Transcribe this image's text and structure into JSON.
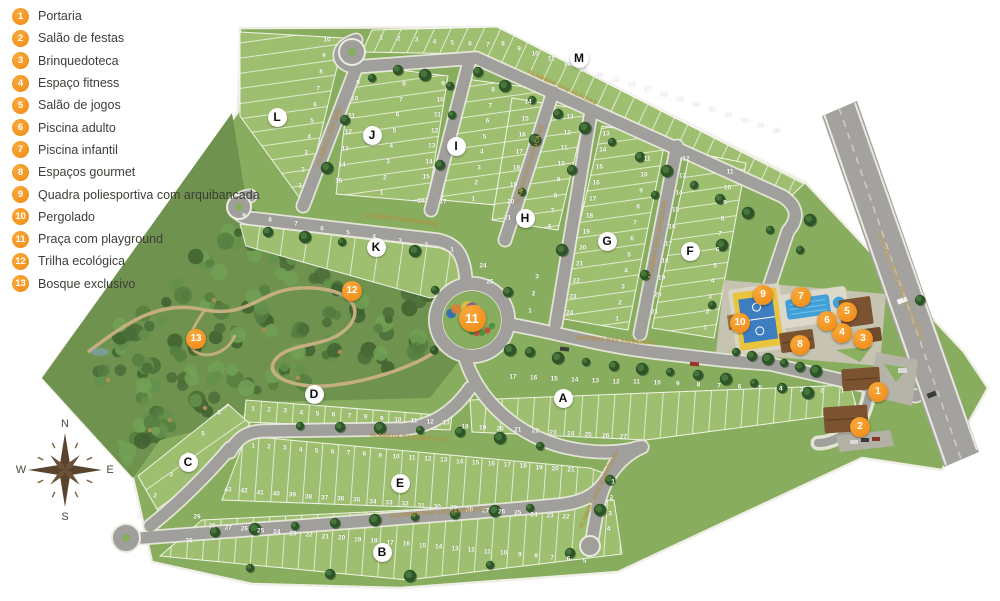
{
  "colors": {
    "accent_orange": "#F28A12",
    "lawn": "#89ad5e",
    "block_green": "#9fbf70",
    "forest": "#6f924e",
    "road": "#a09f9b",
    "curb": "#ecebe3",
    "street_label": "#c09a4e",
    "pool_blue": "#41a0d8",
    "court_blue": "#3e7dbf",
    "court_yellow": "#e9c43d",
    "roof_brown": "#7b5330",
    "compass_brown": "#5a432d"
  },
  "legend": {
    "items": [
      {
        "num": "1",
        "label": "Portaria"
      },
      {
        "num": "2",
        "label": "Salão de festas"
      },
      {
        "num": "3",
        "label": "Brinquedoteca"
      },
      {
        "num": "4",
        "label": "Espaço fitness"
      },
      {
        "num": "5",
        "label": "Salão de jogos"
      },
      {
        "num": "6",
        "label": "Piscina adulto"
      },
      {
        "num": "7",
        "label": "Piscina infantil"
      },
      {
        "num": "8",
        "label": "Espaços gourmet"
      },
      {
        "num": "9",
        "label": "Quadra poliesportiva com arquibancada"
      },
      {
        "num": "10",
        "label": "Pergolado"
      },
      {
        "num": "11",
        "label": "Praça com playground"
      },
      {
        "num": "12",
        "label": "Trilha ecológica"
      },
      {
        "num": "13",
        "label": "Bosque exclusivo"
      }
    ]
  },
  "compass": {
    "n": "N",
    "e": "E",
    "s": "S",
    "w": "W"
  },
  "map": {
    "block_labels": [
      {
        "letter": "A",
        "x": 563,
        "y": 398
      },
      {
        "letter": "B",
        "x": 382,
        "y": 552
      },
      {
        "letter": "C",
        "x": 188,
        "y": 462
      },
      {
        "letter": "D",
        "x": 314,
        "y": 394
      },
      {
        "letter": "E",
        "x": 400,
        "y": 483
      },
      {
        "letter": "F",
        "x": 690,
        "y": 251
      },
      {
        "letter": "G",
        "x": 607,
        "y": 241
      },
      {
        "letter": "H",
        "x": 525,
        "y": 218
      },
      {
        "letter": "I",
        "x": 456,
        "y": 146
      },
      {
        "letter": "J",
        "x": 372,
        "y": 135
      },
      {
        "letter": "K",
        "x": 376,
        "y": 247
      },
      {
        "letter": "L",
        "x": 277,
        "y": 117
      },
      {
        "letter": "M",
        "x": 579,
        "y": 58
      }
    ],
    "markers": [
      {
        "num": "1",
        "x": 878,
        "y": 392
      },
      {
        "num": "2",
        "x": 860,
        "y": 427
      },
      {
        "num": "3",
        "x": 863,
        "y": 339
      },
      {
        "num": "4",
        "x": 842,
        "y": 333
      },
      {
        "num": "5",
        "x": 847,
        "y": 312
      },
      {
        "num": "6",
        "x": 827,
        "y": 321
      },
      {
        "num": "7",
        "x": 801,
        "y": 297
      },
      {
        "num": "8",
        "x": 800,
        "y": 345
      },
      {
        "num": "9",
        "x": 763,
        "y": 295
      },
      {
        "num": "10",
        "x": 740,
        "y": 323
      },
      {
        "num": "11",
        "x": 472,
        "y": 318
      },
      {
        "num": "12",
        "x": 352,
        "y": 291
      },
      {
        "num": "13",
        "x": 196,
        "y": 339
      }
    ],
    "street_labels": [
      {
        "text": "ALAMEDA DAS ACÁCIAS",
        "x": 562,
        "y": 88,
        "rot": 25,
        "cls": ""
      },
      {
        "text": "ALAMEDA DOS PINHAIS",
        "x": 402,
        "y": 220,
        "rot": 7,
        "cls": ""
      },
      {
        "text": "ALAMEDA DOS ANGICOS",
        "x": 408,
        "y": 438,
        "rot": 4,
        "cls": ""
      },
      {
        "text": "ALAMEDA DAS CASTANHEIRAS",
        "x": 438,
        "y": 513,
        "rot": -4,
        "cls": ""
      },
      {
        "text": "AVENIDA DAS FIGUEIRAS",
        "x": 616,
        "y": 341,
        "rot": 4,
        "cls": ""
      },
      {
        "text": "ALAMEDA DAS MAGNÓLIAS",
        "x": 599,
        "y": 490,
        "rot": -65,
        "cls": ""
      },
      {
        "text": "ALAMEDA DOS IPÊS",
        "x": 330,
        "y": 136,
        "rot": -69,
        "cls": ""
      },
      {
        "text": "ALAMEDA DAS SAPUCAIAS",
        "x": 530,
        "y": 165,
        "rot": -72,
        "cls": ""
      },
      {
        "text": "ALAMEDA DAS AROEIRAS",
        "x": 658,
        "y": 240,
        "rot": -79,
        "cls": ""
      },
      {
        "text": "ESTRADA MUNICIPAL DO ROSÁRIO",
        "x": 900,
        "y": 288,
        "rot": 68,
        "cls": "hwy"
      }
    ],
    "lot_strips": [
      {
        "block": "L",
        "x": 327,
        "y": 40,
        "dx": -3,
        "dy": 16.2,
        "values": [
          "10",
          "9",
          "8",
          "7",
          "6",
          "5",
          "4",
          "3",
          "2",
          "1"
        ]
      },
      {
        "block": "M",
        "x": 381,
        "y": 38,
        "dx": 17.8,
        "dy": 1.2,
        "values": [
          "1",
          "2",
          "3",
          "4",
          "5",
          "6",
          "7"
        ]
      },
      {
        "block": "M",
        "x": 503,
        "y": 44,
        "dx": 16.1,
        "dy": 5.1,
        "values": [
          "8",
          "9",
          "10",
          "11",
          "12",
          "13",
          "14",
          "15",
          "16",
          "17",
          "18",
          "19",
          "20",
          "21",
          "22",
          "23",
          "24",
          "25"
        ]
      },
      {
        "block": "J",
        "x": 358,
        "y": 83,
        "dx": -3.2,
        "dy": 16.4,
        "values": [
          "9",
          "10",
          "11",
          "12",
          "13",
          "14",
          "15"
        ]
      },
      {
        "block": "J",
        "x": 404,
        "y": 84,
        "dx": -3.2,
        "dy": 15.6,
        "values": [
          "8",
          "7",
          "6",
          "5",
          "4",
          "3",
          "2",
          "1"
        ]
      },
      {
        "block": "I",
        "x": 443,
        "y": 84,
        "dx": -2.8,
        "dy": 15.5,
        "values": [
          "9",
          "10",
          "11",
          "12",
          "13",
          "14",
          "15"
        ]
      },
      {
        "block": "I",
        "x": 421,
        "y": 201,
        "dx": 22,
        "dy": 1,
        "values": [
          "16",
          "17"
        ]
      },
      {
        "block": "I",
        "x": 493,
        "y": 90,
        "dx": -2.8,
        "dy": 15.5,
        "values": [
          "8",
          "7",
          "6",
          "5",
          "4",
          "3",
          "2",
          "1"
        ]
      },
      {
        "block": "H",
        "x": 528,
        "y": 102,
        "dx": -2.9,
        "dy": 16.6,
        "values": [
          "14",
          "15",
          "16",
          "17",
          "18",
          "19",
          "20",
          "21"
        ]
      },
      {
        "block": "H",
        "x": 570,
        "y": 117,
        "dx": -2.9,
        "dy": 15.7,
        "values": [
          "13",
          "12",
          "11",
          "10",
          "9",
          "8",
          "7",
          "6"
        ]
      },
      {
        "block": "G",
        "x": 606,
        "y": 134,
        "dx": -3.3,
        "dy": 16.3,
        "values": [
          "13",
          "14",
          "15",
          "16",
          "17",
          "18",
          "19",
          "20",
          "21",
          "22",
          "23",
          "24"
        ]
      },
      {
        "block": "G",
        "x": 647,
        "y": 159,
        "dx": -3,
        "dy": 16,
        "values": [
          "11",
          "10",
          "9",
          "8",
          "7",
          "6",
          "5",
          "4",
          "3",
          "2",
          "1"
        ]
      },
      {
        "block": "F",
        "x": 686,
        "y": 159,
        "dx": -3.5,
        "dy": 17,
        "values": [
          "12",
          "13",
          "14",
          "15",
          "16",
          "17",
          "18",
          "19",
          "20",
          "21"
        ]
      },
      {
        "block": "F",
        "x": 730,
        "y": 172,
        "dx": -2.5,
        "dy": 15.6,
        "values": [
          "11",
          "10",
          "9",
          "8",
          "7",
          "6",
          "5",
          "4",
          "3",
          "2",
          "1"
        ]
      },
      {
        "block": "K",
        "x": 244,
        "y": 216,
        "dx": 26,
        "dy": 4.2,
        "values": [
          "9",
          "8",
          "7",
          "6",
          "5",
          "4",
          "3",
          "2",
          "1"
        ]
      },
      {
        "block": "K",
        "x": 483,
        "y": 266,
        "dx": 7,
        "dy": 16,
        "values": [
          "24",
          "25"
        ]
      },
      {
        "block": "A",
        "x": 537,
        "y": 277,
        "dx": -3.5,
        "dy": 17,
        "values": [
          "3",
          "2",
          "1"
        ]
      },
      {
        "block": "A",
        "x": 513,
        "y": 377,
        "dx": 20.6,
        "dy": 0.9,
        "values": [
          "17",
          "16",
          "15",
          "14",
          "13",
          "12",
          "11",
          "10",
          "9",
          "8",
          "7",
          "6",
          "5",
          "4",
          "3",
          "2",
          "1"
        ]
      },
      {
        "block": "A",
        "x": 465,
        "y": 427,
        "dx": 17.6,
        "dy": 1.1,
        "values": [
          "18",
          "19",
          "20",
          "21",
          "22",
          "23",
          "24",
          "25",
          "26",
          "27"
        ]
      },
      {
        "block": "D",
        "x": 253,
        "y": 409,
        "dx": 16.1,
        "dy": 1.2,
        "values": [
          "1",
          "2",
          "3",
          "4",
          "5",
          "6",
          "7",
          "8",
          "9",
          "10",
          "11",
          "12",
          "13"
        ]
      },
      {
        "block": "E",
        "x": 253,
        "y": 446,
        "dx": 15.9,
        "dy": 1.2,
        "values": [
          "1",
          "2",
          "3",
          "4",
          "5",
          "6",
          "7",
          "8",
          "9",
          "10",
          "11",
          "12",
          "13",
          "14",
          "15",
          "16",
          "17",
          "18",
          "19",
          "20",
          "21"
        ]
      },
      {
        "block": "E",
        "x": 228,
        "y": 490,
        "dx": 16.1,
        "dy": 1.3,
        "values": [
          "43",
          "42",
          "41",
          "40",
          "39",
          "38",
          "37",
          "36",
          "35",
          "34",
          "33",
          "32",
          "31",
          "30",
          "29",
          "28",
          "27",
          "26",
          "25",
          "24",
          "23",
          "22"
        ]
      },
      {
        "block": "E",
        "x": 613,
        "y": 482,
        "dx": -1.5,
        "dy": 15.8,
        "values": [
          "1",
          "2",
          "3",
          "4"
        ]
      },
      {
        "block": "B",
        "x": 212,
        "y": 526,
        "dx": 16.2,
        "dy": 1.5,
        "values": [
          "28",
          "27",
          "26",
          "25",
          "24",
          "23",
          "22",
          "21",
          "20",
          "19",
          "18",
          "17",
          "16",
          "15",
          "14",
          "13",
          "12",
          "11",
          "10",
          "9",
          "8",
          "7",
          "6",
          "5"
        ]
      },
      {
        "block": "C",
        "x": 219,
        "y": 413,
        "dx": -16,
        "dy": 20.8,
        "values": [
          "6",
          "5",
          "4",
          "3",
          "2",
          "1"
        ]
      },
      {
        "block": "C",
        "x": 197,
        "y": 517,
        "dx": -8,
        "dy": 24,
        "values": [
          "29",
          "30"
        ]
      }
    ]
  }
}
